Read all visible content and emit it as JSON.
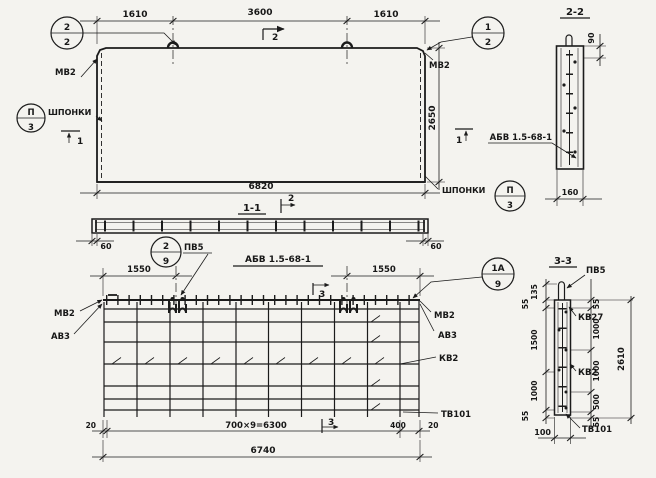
{
  "meta": {
    "background": "#f4f3ef",
    "ink": "#1b1b1b",
    "drawing_kind": "precast concrete panel working drawing"
  },
  "elevation": {
    "dim_left": "1610",
    "dim_mid": "3600",
    "dim_right": "1610",
    "dim_width": "6820",
    "dim_height": "2650",
    "label_mv2_left": "МВ2",
    "label_mv2_right": "МВ2",
    "label_keys_left": "ШПОНКИ",
    "label_keys_right": "ШПОНКИ",
    "callout_22_top": "2",
    "callout_22_bot": "2",
    "callout_12_top": "1",
    "callout_12_bot": "2",
    "callout_p3_left_top": "П",
    "callout_p3_left_bot": "3",
    "callout_p3_right_top": "П",
    "callout_p3_right_bot": "3",
    "cut2_top": "2",
    "cut2_bottom": "2",
    "cut1_left": "1",
    "cut1_right": "1",
    "section_ref": "1-1"
  },
  "section_2_2": {
    "title": "2-2",
    "dim_depth": "90",
    "dim_width": "160",
    "label_series": "АБВ 1.5-68-1"
  },
  "section_1_1": {
    "dim_end_left": "60",
    "dim_end_right": "60",
    "callout_top": "2",
    "callout_bot": "9",
    "label_pv5": "ПВ5",
    "title_series": "АБВ 1.5-68-1"
  },
  "plan": {
    "dim_loop_left": "1550",
    "dim_loop_right": "1550",
    "dim_edge_left": "20",
    "dim_spacing": "700×9=6300",
    "dim_end": "400",
    "dim_edge_right": "20",
    "dim_total": "6740",
    "label_mv2_left": "МВ2",
    "label_av3_left": "АВ3",
    "label_mv2_right": "МВ2",
    "label_av3_right": "АВ3",
    "label_kv2": "КВ2",
    "label_tv101": "ТВ101",
    "callout_top": "1А",
    "callout_bot": "9",
    "cut3_top": "3",
    "cut3_bottom": "3"
  },
  "section_3_3": {
    "title": "3-3",
    "label_pv5": "ПВ5",
    "label_kv27": "КВ27",
    "label_kv2": "КВ2",
    "label_tv101": "ТВ101",
    "dims_left": [
      "135",
      "55",
      "1500",
      "1000",
      "55"
    ],
    "dims_right": [
      "55",
      "1000",
      "1000",
      "500",
      "55"
    ],
    "dim_total": "2610",
    "dim_width": "100"
  }
}
